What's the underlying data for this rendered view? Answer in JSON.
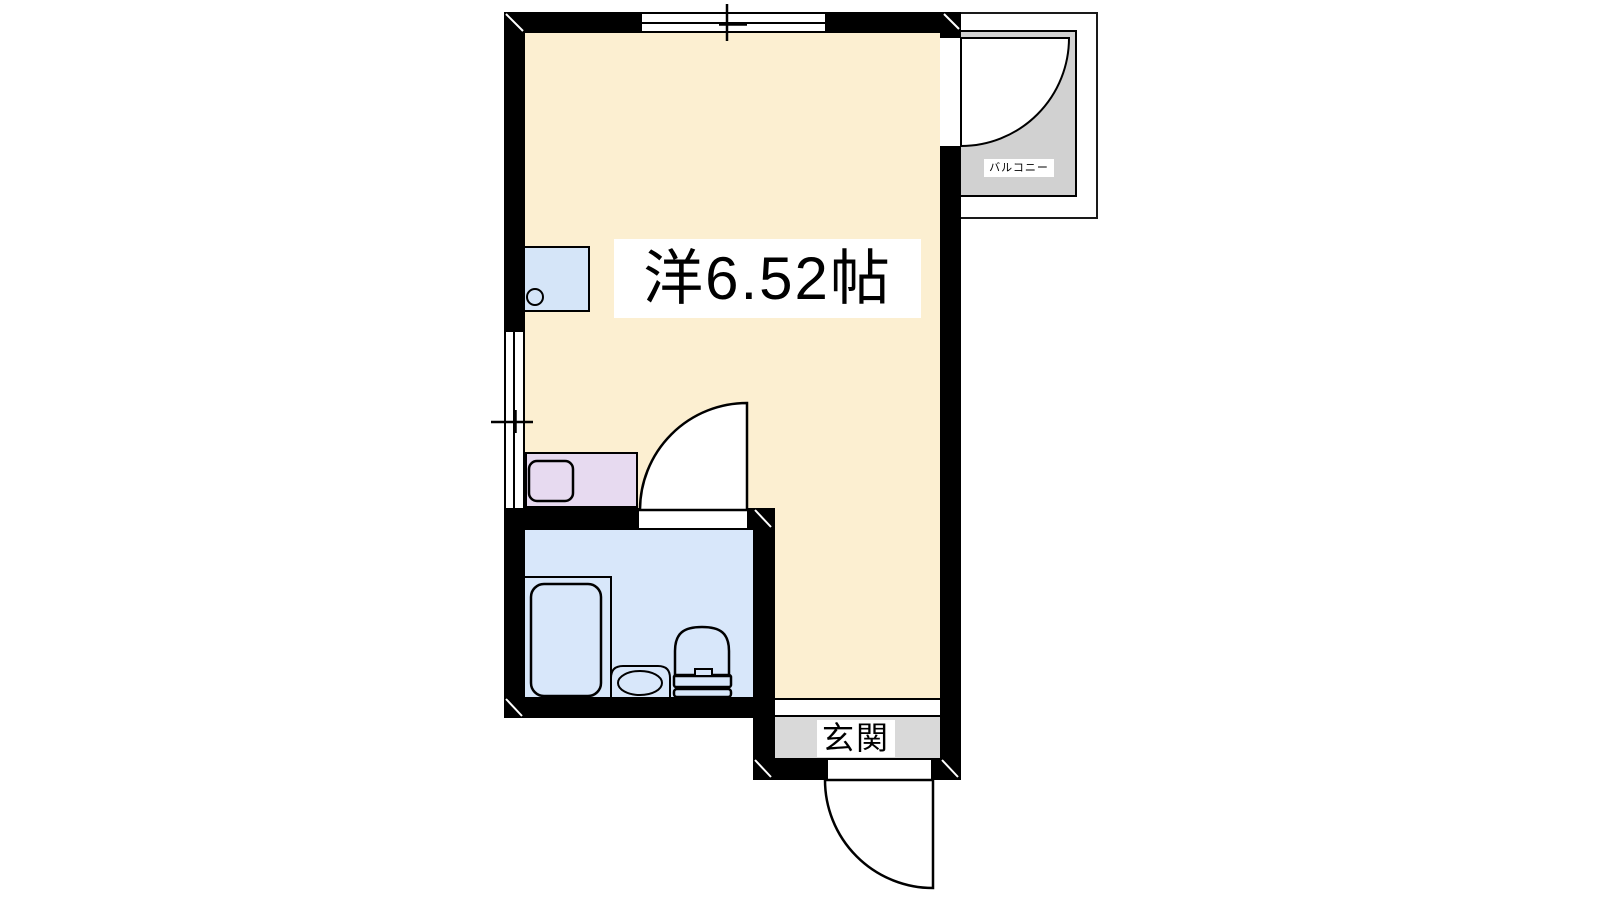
{
  "floorplan": {
    "room": {
      "label": "洋6.52帖"
    },
    "balcony": {
      "label": "バルコニー"
    },
    "entrance": {
      "label": "玄関"
    },
    "colors": {
      "wall": "#000000",
      "room_floor": "#FCEFD1",
      "bathroom_floor": "#D8E7FA",
      "kitchen_sink_counter": "#D5E5F8",
      "kitchen_counter": "#E7DAF0",
      "balcony_floor": "#D1D1D1",
      "entrance_floor": "#D9D9D9",
      "label_background": "#FFFFFF"
    }
  }
}
